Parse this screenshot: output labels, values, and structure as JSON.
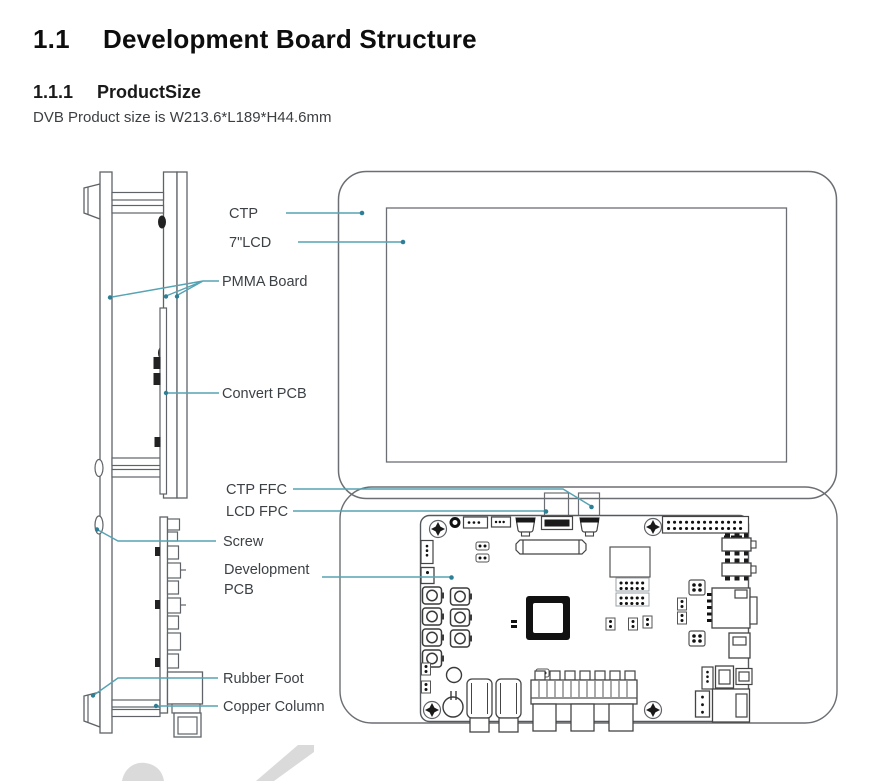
{
  "page": {
    "heading": {
      "number": "1.1",
      "title": "Development Board Structure"
    },
    "subheading": {
      "number": "1.1.1",
      "title": "ProductSize"
    },
    "body_text": "DVB Product size is W213.6*L189*H44.6mm"
  },
  "diagram": {
    "labels": {
      "ctp": "CTP",
      "lcd": "7\"LCD",
      "pmma": "PMMA Board",
      "convert_pcb": "Convert PCB",
      "ctp_ffc": "CTP FFC",
      "lcd_fpc": "LCD FPC",
      "screw": "Screw",
      "development_line1": "Development",
      "development_line2": "PCB",
      "rubber_foot": "Rubber Foot",
      "copper_column": "Copper Column"
    },
    "colors": {
      "leader": "#56a3b4",
      "leader_dot": "#2e7f96",
      "line": "#5f6368",
      "component": "#1a1a1a",
      "watermark": "#dadada"
    }
  }
}
